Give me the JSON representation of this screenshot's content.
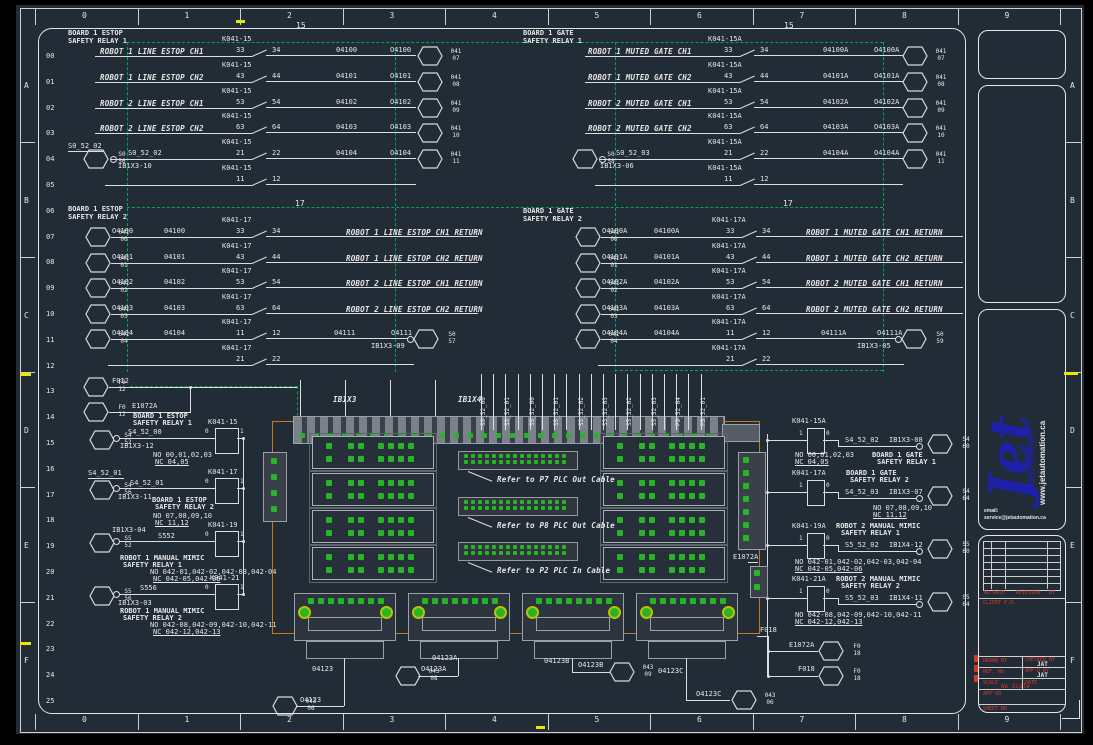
{
  "colors": {
    "bg": "#222c37",
    "wire": "#dedede",
    "bus_green": "#00a550",
    "led_green": "#27b427",
    "panel_orange": "#c8781e",
    "logo_blue": "#1c21a8",
    "red": "#d23a2e",
    "yellow": "#e8e800"
  },
  "frame": {
    "top_ruler": [
      "0",
      "1",
      "2",
      "3",
      "4",
      "5",
      "6",
      "7",
      "8",
      "9"
    ],
    "bottom_ruler": [
      "0",
      "1",
      "2",
      "3",
      "4",
      "5",
      "6",
      "7",
      "8",
      "9"
    ],
    "left_letters": [
      "A",
      "B",
      "C",
      "D",
      "E",
      "F"
    ],
    "right_letters": [
      "A",
      "B",
      "C",
      "D",
      "E",
      "F"
    ],
    "row_numbers": [
      "00",
      "01",
      "02",
      "03",
      "04",
      "05",
      "06",
      "07",
      "08",
      "09",
      "10",
      "11",
      "12",
      "13",
      "14",
      "15",
      "16",
      "17",
      "18",
      "19",
      "20",
      "21",
      "22",
      "23",
      "24",
      "25"
    ]
  },
  "buses": {
    "estop1": "15",
    "gate1": "15",
    "estop2": "17",
    "gate2": "17"
  },
  "sections": {
    "estop1": {
      "title": [
        "BOARD 1 ESTOP",
        "SAFETY RELAY 1"
      ],
      "rows": [
        {
          "desc": "ROBOT 1 LINE ESTOP CH1",
          "relay": "K041-15",
          "pins": [
            "33",
            "34"
          ],
          "wire": "04100",
          "addr": "O4100",
          "hex": [
            "041",
            "07"
          ]
        },
        {
          "desc": "ROBOT 1 LINE ESTOP CH2",
          "relay": "K041-15",
          "pins": [
            "43",
            "44"
          ],
          "wire": "04101",
          "addr": "O4101",
          "hex": [
            "041",
            "08"
          ]
        },
        {
          "desc": "ROBOT 2 LINE ESTOP CH1",
          "relay": "K041-15",
          "pins": [
            "53",
            "54"
          ],
          "wire": "04102",
          "addr": "O4102",
          "hex": [
            "041",
            "09"
          ]
        },
        {
          "desc": "ROBOT 2 LINE ESTOP CH2",
          "relay": "K041-15",
          "pins": [
            "63",
            "64"
          ],
          "wire": "04103",
          "addr": "O4103",
          "hex": [
            "041",
            "10"
          ]
        },
        {
          "src_above": "S0_52_02",
          "src_hex": [
            "S0",
            "56"
          ],
          "src_wire": "S0_52_02",
          "src_term": "IB1X3-10",
          "relay": "K041-15",
          "pins": [
            "21",
            "22"
          ],
          "wire": "04104",
          "addr": "O4104",
          "hex": [
            "041",
            "11"
          ]
        },
        {
          "relay": "K041-15",
          "pins": [
            "11",
            "12"
          ]
        }
      ]
    },
    "gate1": {
      "title": [
        "BOARD 1 GATE",
        "SAFETY RELAY 1"
      ],
      "rows": [
        {
          "desc": "ROBOT 1 MUTED GATE CH1",
          "relay": "K041-15A",
          "pins": [
            "33",
            "34"
          ],
          "wire": "04100A",
          "addr": "O4100A",
          "hex": [
            "041",
            "07"
          ]
        },
        {
          "desc": "ROBOT 1 MUTED GATE CH2",
          "relay": "K041-15A",
          "pins": [
            "43",
            "44"
          ],
          "wire": "04101A",
          "addr": "O4101A",
          "hex": [
            "041",
            "08"
          ]
        },
        {
          "desc": "ROBOT 2 MUTED GATE CH1",
          "relay": "K041-15A",
          "pins": [
            "53",
            "54"
          ],
          "wire": "04102A",
          "addr": "O4102A",
          "hex": [
            "041",
            "09"
          ]
        },
        {
          "desc": "ROBOT 2 MUTED GATE CH2",
          "relay": "K041-15A",
          "pins": [
            "63",
            "64"
          ],
          "wire": "04103A",
          "addr": "O4103A",
          "hex": [
            "041",
            "10"
          ]
        },
        {
          "src_hex": [
            "S0",
            "58"
          ],
          "src_wire": "S0_52_03",
          "src_term": "IB1X3-06",
          "relay": "K041-15A",
          "pins": [
            "21",
            "22"
          ],
          "wire": "04104A",
          "addr": "O4104A",
          "hex": [
            "041",
            "11"
          ]
        },
        {
          "relay": "K041-15A",
          "pins": [
            "11",
            "12"
          ]
        }
      ]
    },
    "estop2": {
      "title": [
        "BOARD 1 ESTOP",
        "SAFETY RELAY 2"
      ],
      "rows": [
        {
          "hex": [
            "041",
            "00"
          ],
          "addr": "O4100",
          "wire": "04100",
          "relay": "K041-17",
          "pins": [
            "33",
            "34"
          ],
          "desc": "ROBOT 1 LINE ESTOP CH1 RETURN"
        },
        {
          "hex": [
            "041",
            "01"
          ],
          "addr": "O4101",
          "wire": "04101",
          "relay": "K041-17",
          "pins": [
            "43",
            "44"
          ],
          "desc": "ROBOT 1 LINE ESTOP CH2 RETURN"
        },
        {
          "hex": [
            "041",
            "02"
          ],
          "addr": "O4102",
          "wire": "04102",
          "relay": "K041-17",
          "pins": [
            "53",
            "54"
          ],
          "desc": "ROBOT 2 LINE ESTOP CH1 RETURN"
        },
        {
          "hex": [
            "041",
            "03"
          ],
          "addr": "O4103",
          "wire": "04103",
          "relay": "K041-17",
          "pins": [
            "63",
            "64"
          ],
          "desc": "ROBOT 2 LINE ESTOP CH2 RETURN"
        },
        {
          "hex": [
            "041",
            "04"
          ],
          "addr": "O4104",
          "wire": "04104",
          "relay": "K041-17",
          "pins": [
            "11",
            "12"
          ],
          "wire2": "04111",
          "addr2": "O4111",
          "term": "IB1X3-09",
          "end_hex": [
            "S0",
            "57"
          ]
        },
        {
          "relay": "K041-17",
          "pins": [
            "21",
            "22"
          ]
        }
      ]
    },
    "gate2": {
      "title": [
        "BOARD 1 GATE",
        "SAFETY RELAY 2"
      ],
      "rows": [
        {
          "hex": [
            "041",
            "00"
          ],
          "addr": "O4100A",
          "wire": "04100A",
          "relay": "K041-17A",
          "pins": [
            "33",
            "34"
          ],
          "desc": "ROBOT 1 MUTED GATE CH1 RETURN"
        },
        {
          "hex": [
            "041",
            "01"
          ],
          "addr": "O4101A",
          "wire": "04101A",
          "relay": "K041-17A",
          "pins": [
            "43",
            "44"
          ],
          "desc": "ROBOT 1 MUTED GATE CH2 RETURN"
        },
        {
          "hex": [
            "041",
            "02"
          ],
          "addr": "O4102A",
          "wire": "04102A",
          "relay": "K041-17A",
          "pins": [
            "53",
            "54"
          ],
          "desc": "ROBOT 2 MUTED GATE CH1 RETURN"
        },
        {
          "hex": [
            "041",
            "03"
          ],
          "addr": "O4103A",
          "wire": "04103A",
          "relay": "K041-17A",
          "pins": [
            "63",
            "64"
          ],
          "desc": "ROBOT 2 MUTED GATE CH2 RETURN"
        },
        {
          "hex": [
            "041",
            "04"
          ],
          "addr": "O4104A",
          "wire": "04104A",
          "relay": "K041-17A",
          "pins": [
            "11",
            "12"
          ],
          "wire2": "04111A",
          "addr2": "O4111A",
          "term": "IB1X3-05",
          "end_hex": [
            "S0",
            "59"
          ]
        },
        {
          "relay": "K041-17A",
          "pins": [
            "21",
            "22"
          ]
        }
      ]
    }
  },
  "coils_left": [
    {
      "hex": [
        "F0",
        "12"
      ],
      "label": "F012"
    },
    {
      "hex": [
        "F0",
        "12"
      ],
      "label": "E1072A",
      "board": [
        "BOARD 1 ESTOP",
        "SAFETY RELAY 1"
      ],
      "relay": "K041-15",
      "pins": [
        "0",
        "1"
      ]
    },
    {
      "hex": [
        "S4",
        "52"
      ],
      "wire": "S4_52_00",
      "term": "IB1X3-12",
      "no": "NO 00,01,02,03",
      "nc": "NC 04,05"
    },
    {
      "above": "S4_52_01",
      "hex": [
        "S4",
        "56"
      ],
      "wire": "S4_52_01",
      "term": "IB1X3-11",
      "board": [
        "BOARD 1 ESTOP",
        "SAFETY RELAY 2"
      ],
      "no": "NO 07,08,09,10",
      "nc": "NC 11,12",
      "relay": "K041-17",
      "pins": [
        "0",
        "1"
      ]
    },
    {
      "hex": [
        "S5",
        "52"
      ],
      "term_above": "IB1X3-04",
      "wire": "S552",
      "relay": "K041-19",
      "pins": [
        "0",
        "1"
      ],
      "board": [
        "ROBOT 1 MANUAL MIMIC",
        "SAFETY RELAY 1"
      ],
      "no": "NO 042-01,042-02,042-03,042-04",
      "nc": "NC 042-05,042-06"
    },
    {
      "hex": [
        "S5",
        "56"
      ],
      "wire": "S556",
      "term": "IB1X3-03",
      "relay": "K041-21",
      "pins": [
        "0",
        "1"
      ],
      "board": [
        "ROBOT 1 MANUAL MIMIC",
        "SAFETY RELAY 2"
      ],
      "no": "NO 042-08,042-09,042-10,042-11",
      "nc": "NC 042-12,042-13"
    }
  ],
  "coils_right": [
    {
      "relay": "K041-15A",
      "pins": [
        "1",
        "0"
      ],
      "wire": "S4_52_02",
      "term": "IB1X3-08",
      "hex": [
        "S4",
        "60"
      ],
      "no": "NO 00,01,02,03",
      "nc": "NC 04,05",
      "board": [
        "BOARD 1 GATE",
        "SAFETY RELAY 1"
      ]
    },
    {
      "relay": "K041-17A",
      "pins": [
        "1",
        "0"
      ],
      "wire": "S4_52_03",
      "term": "IB1X3-07",
      "hex": [
        "S4",
        "64"
      ],
      "no": "NO 07,08,09,10",
      "nc": "NC 11,12",
      "board": [
        "BOARD 1 GATE",
        "SAFETY RELAY 2"
      ]
    },
    {
      "relay": "K041-19A",
      "pins": [
        "1",
        "0"
      ],
      "wire": "S5_52_02",
      "term": "IB1X4-12",
      "hex": [
        "S5",
        "60"
      ],
      "no": "NO 042-01,042-02,042-03,042-04",
      "nc": "NC 042-05,042-06",
      "board": [
        "ROBOT 2 MANUAL MIMIC",
        "SAFETY RELAY 1"
      ]
    },
    {
      "relay": "K041-21A",
      "pins": [
        "1",
        "0"
      ],
      "wire": "S5_52_03",
      "term": "IB1X4-11",
      "hex": [
        "S5",
        "64"
      ],
      "no": "NO 042-08,042-09,042-10,042-11",
      "nc": "NC 042-12,042-13",
      "board": [
        "ROBOT 2 MANUAL MIMIC",
        "SAFETY RELAY 2"
      ]
    }
  ],
  "right_feeds": [
    {
      "label": "E1072A",
      "hex": [
        "F0",
        "18"
      ]
    },
    {
      "label": "F018",
      "hex": [
        "F0",
        "18"
      ]
    }
  ],
  "panel": {
    "strip_labels": [
      "IB1X3",
      "IB1X4"
    ],
    "inner_label": "E1072A",
    "feed_label": "F018",
    "notes": [
      "Refer to P7 PLC Out Cable",
      "Refer to P8 PLC Out Cable",
      "Refer to P2 PLC In Cable"
    ],
    "vertical_labels": [
      "S3_52_00",
      "S3_52_01",
      "S5_52_00",
      "S5_52_01",
      "S3_52_02",
      "S3_52_03",
      "S5_52_02",
      "S5_52_03",
      "P5_52_04",
      "P5_52_01"
    ],
    "bottom_tags": [
      {
        "wire": "04123",
        "addr": "O4123",
        "hex": [
          "043",
          "06"
        ]
      },
      {
        "wire": "04123A",
        "addr": "O4123A",
        "hex": [
          "043",
          "08"
        ]
      },
      {
        "wire": "04123B",
        "addr": "O4123B",
        "hex": [
          "043",
          "09"
        ]
      },
      {
        "wire": "04123C",
        "addr": "O4123C",
        "hex": [
          "043",
          "06"
        ]
      }
    ]
  },
  "logo": {
    "brand": "Jet",
    "word": "Automation",
    "site": "www.jetautomation.ca",
    "email_label": "email:",
    "email": "service@jetautomation.ca"
  },
  "title_block": {
    "rev_headers": [
      "NO",
      "DATE",
      "REVISION",
      "BY"
    ],
    "client_label": "CLIENT P.O.",
    "drawn_label": "DRAWN BY",
    "checked_label": "CHECKED BY",
    "checked_value": "JAT",
    "ref_label": "REF. NO",
    "appd_label": "APP'D BY",
    "appd_value": "JAT",
    "scale_label": "SCALE",
    "scale_value": "No Scale",
    "date_label": "DATE",
    "approved_label": "APP'VD",
    "sheet_label": "SHEET NO"
  }
}
